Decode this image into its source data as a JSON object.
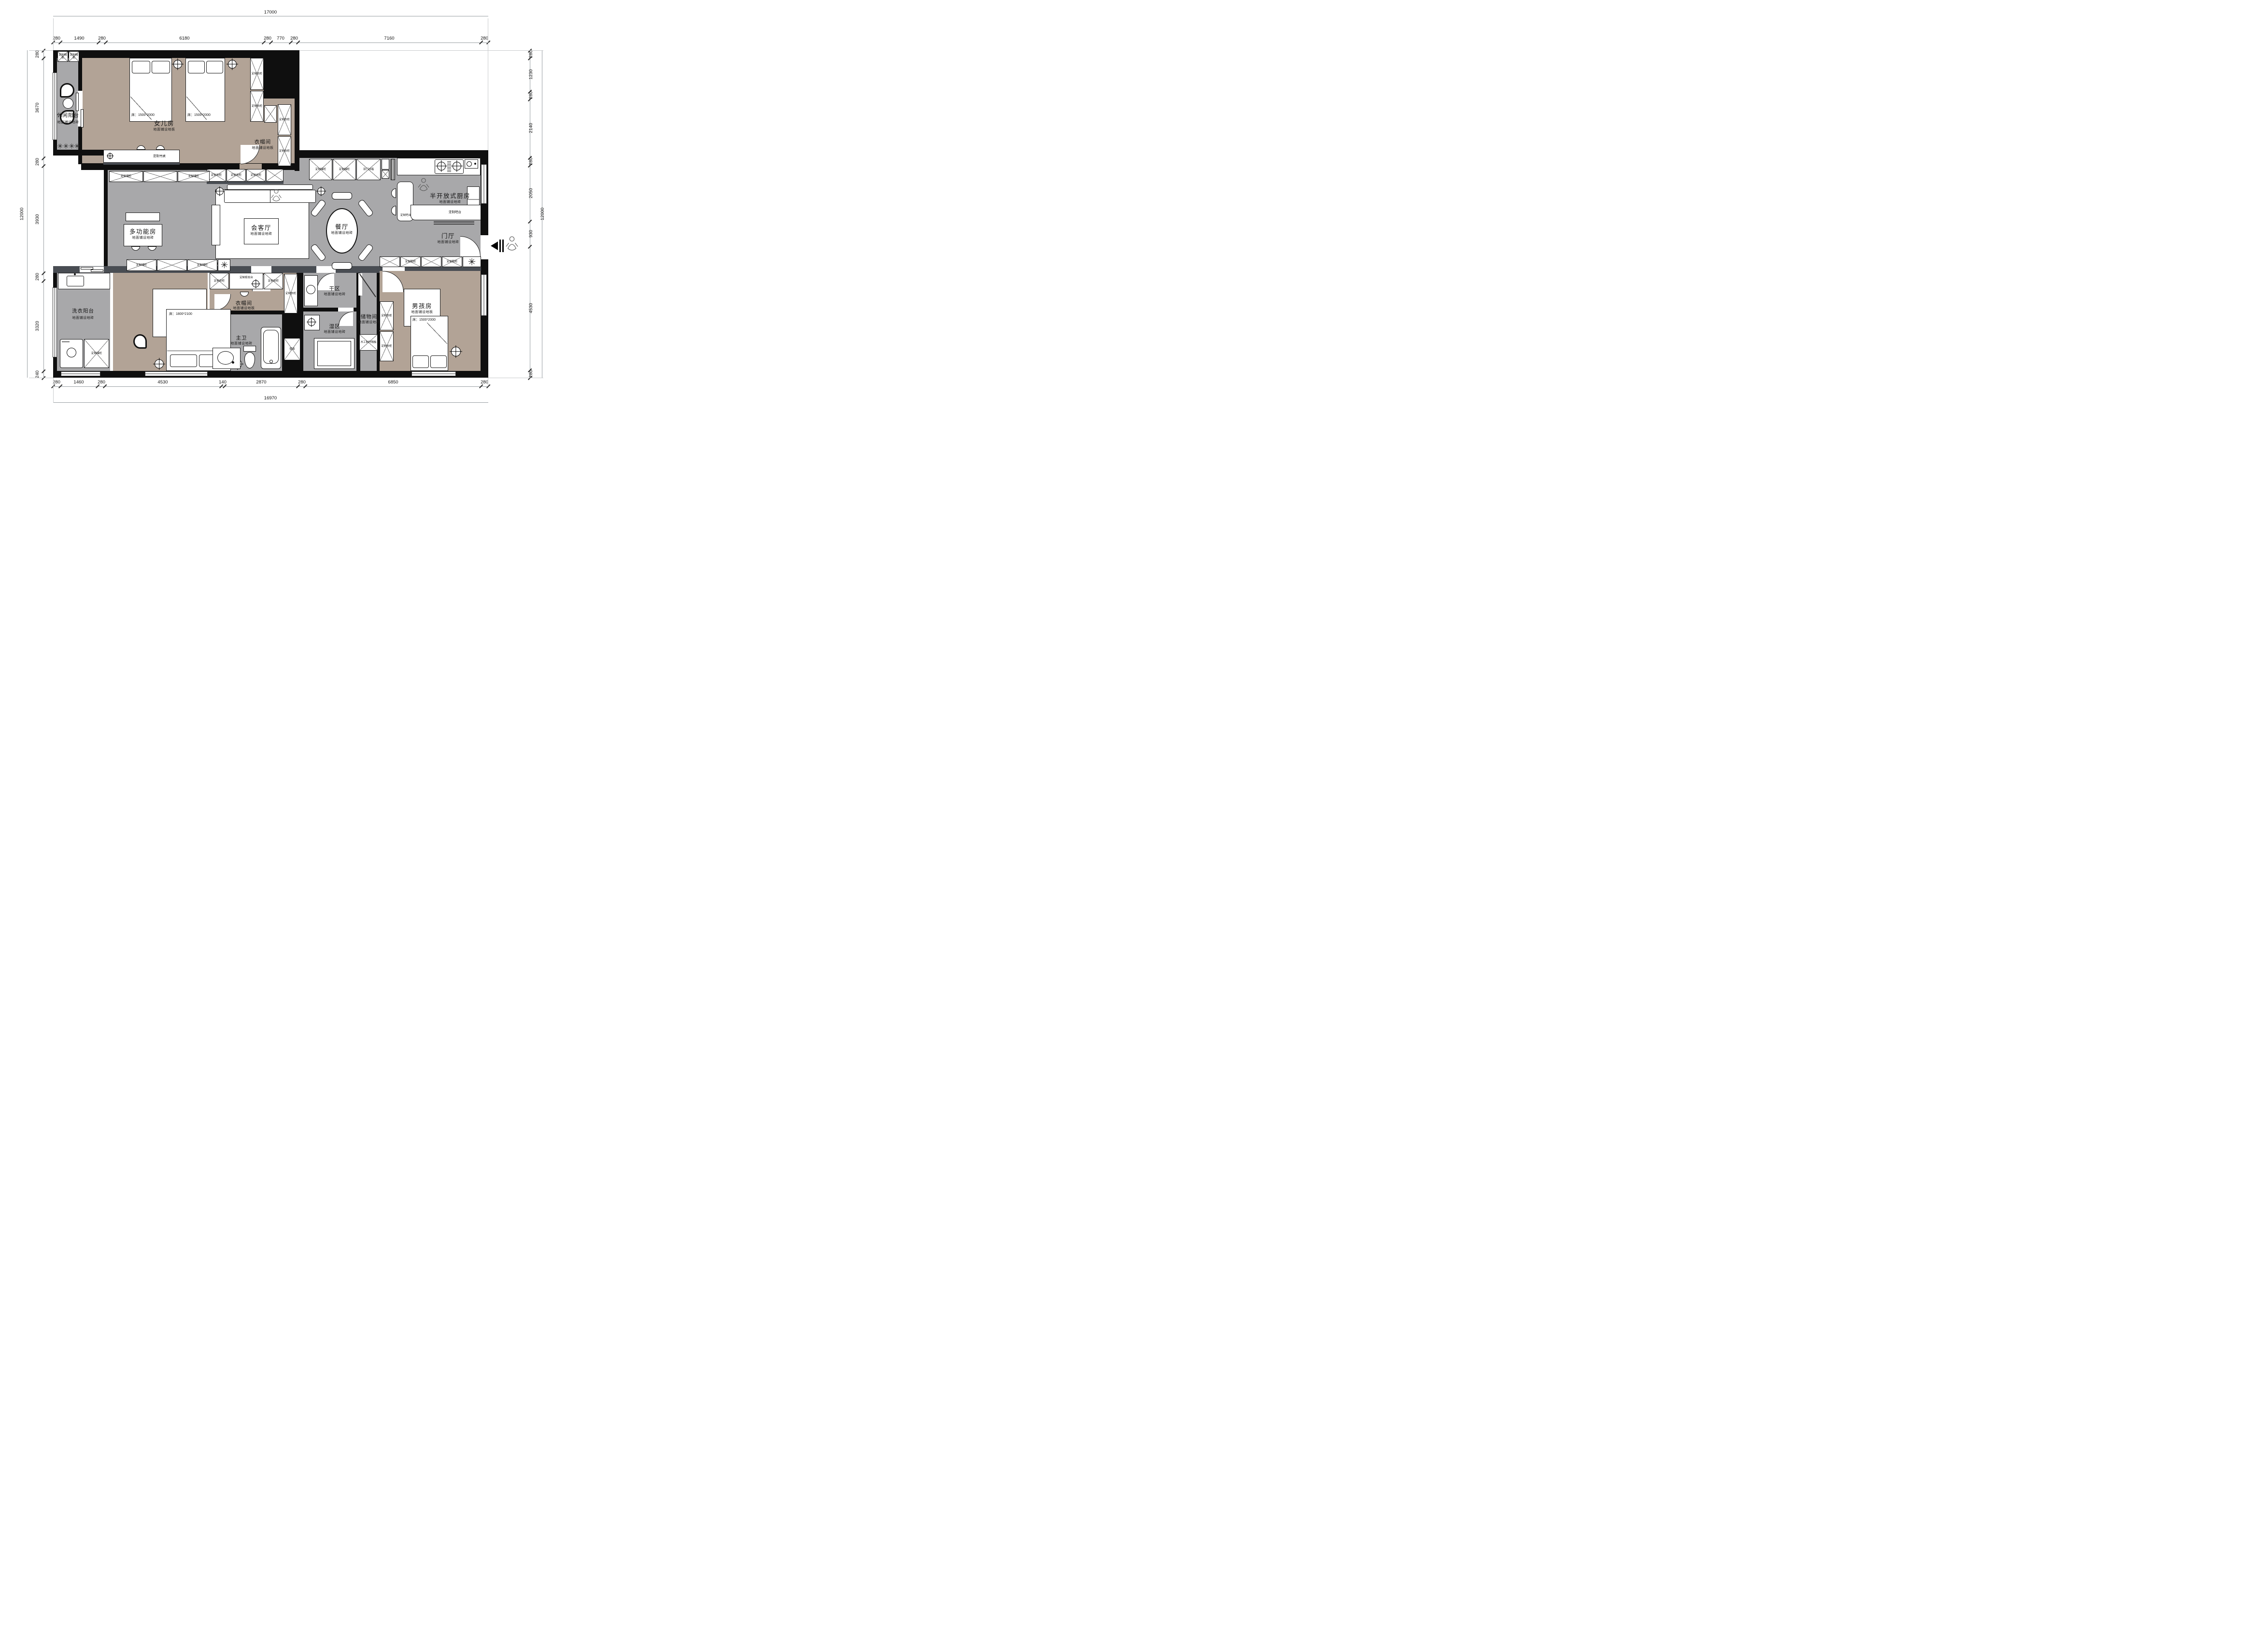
{
  "dims": {
    "top": {
      "total": "17000",
      "s0": "280",
      "s1": "1490",
      "s2": "280",
      "s3": "6180",
      "s4": "280",
      "s5": "770",
      "s6": "280",
      "s7": "7160",
      "s8": "280"
    },
    "bottom": {
      "total": "16970",
      "s0": "280",
      "s1": "1460",
      "s2": "280",
      "s3": "4530",
      "s4": "140",
      "s5": "2870",
      "s6": "280",
      "s7": "6850",
      "s8": "280"
    },
    "left": {
      "total": "12000",
      "s0": "280",
      "s1": "3670",
      "s2": "280",
      "s3": "3930",
      "s4": "280",
      "s5": "3320",
      "s6": "240"
    },
    "right": {
      "total": "12000",
      "s0": "280",
      "s1": "1230",
      "s2": "280",
      "s3": "2140",
      "s4": "280",
      "s5": "2050",
      "s6": "930",
      "s7": "4530",
      "s8": "280"
    }
  },
  "rooms": {
    "leisure_balcony": {
      "name": "休闲阳台",
      "floor": "地面铺设地砖"
    },
    "daughter": {
      "name": "女儿房",
      "floor": "地面铺设地板",
      "bed": "床：1500*2000"
    },
    "cloak_top": {
      "name": "衣帽间",
      "floor": "地面铺设地板"
    },
    "multi": {
      "name": "多功能房",
      "floor": "地面铺设地砖"
    },
    "living": {
      "name": "会客厅",
      "floor": "地面铺设地砖"
    },
    "dining": {
      "name": "餐厅",
      "floor": "地面铺设地砖"
    },
    "kitchen": {
      "name": "半开放式厨房",
      "floor": "地面铺设地砖"
    },
    "foyer": {
      "name": "门厅",
      "floor": "地面铺设地砖"
    },
    "laundry": {
      "name": "洗衣阳台",
      "floor": "地面铺设地砖"
    },
    "master": {
      "name": "主人房",
      "floor": "地面铺设地板",
      "bed": "床：1800*2100"
    },
    "cloak_master": {
      "name": "衣帽间",
      "floor": "地面铺设地板"
    },
    "bath": {
      "name": "主卫",
      "floor": "地面铺设地砖"
    },
    "dry": {
      "name": "干区",
      "floor": "地面铺设地砖"
    },
    "wet": {
      "name": "湿区",
      "floor": "地面铺设地砖"
    },
    "storage": {
      "name": "储物间",
      "floor": "地面铺设地砖"
    },
    "boy": {
      "name": "男孩房",
      "floor": "地面铺设地板",
      "bed": "床：1500*2000"
    }
  },
  "furniture": {
    "desk": "定制书桌",
    "storage_cab": "定制储柜",
    "wardrobe": "定制衣柜",
    "fridge": "双门冰箱",
    "bar": "定制吧台",
    "shoe_cab": "定制鞋柜",
    "dresser": "定制梳妆台",
    "partition": "木工制作隔板",
    "niche": "壁龛"
  },
  "colors": {
    "wood_floor": "#b2a396",
    "tile_floor": "#a8a8aa",
    "wall": "#0f0f0f",
    "accent_wall": "#494d53"
  }
}
